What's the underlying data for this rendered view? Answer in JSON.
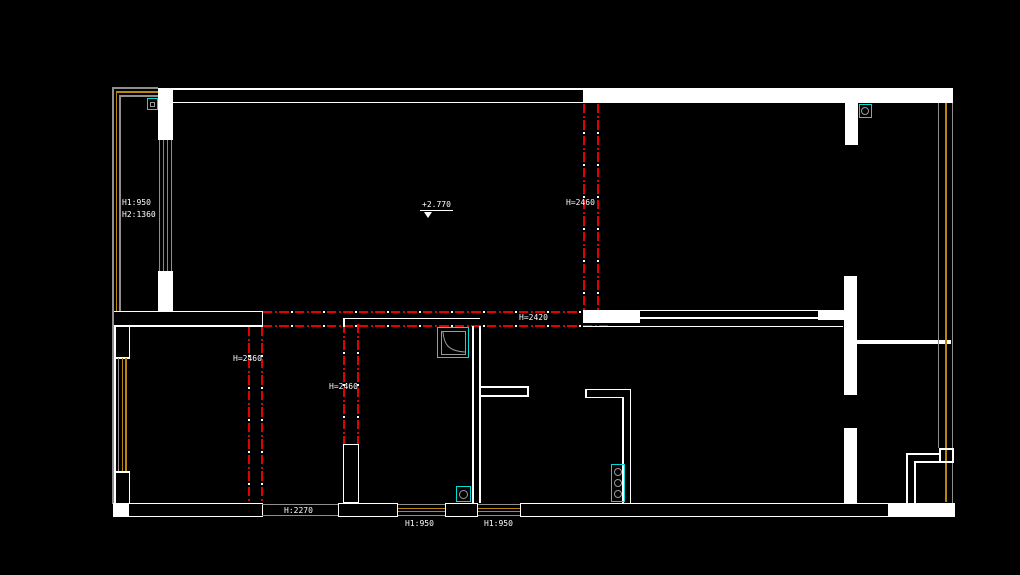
{
  "plan": {
    "annotations": {
      "left_window_h1": "H1:950",
      "left_window_h2": "H2:1360",
      "elevation": "+2.770",
      "h2460_top": "H=2460",
      "h2420_mid": "H=2420",
      "h2460_room_left": "H=2460",
      "h2460_room_mid": "H=2460",
      "h2270_door": "H:2270",
      "h950_window_1": "H1:950",
      "h950_window_2": "H1:950"
    },
    "colors": {
      "background": "#000000",
      "wall": "#ffffff",
      "ceiling_height_line": "#e50000",
      "fixture_cyan": "#00dcdc",
      "window_frame_yellow": "#b8860b",
      "window_glass_gray": "#8f8f8f"
    }
  }
}
